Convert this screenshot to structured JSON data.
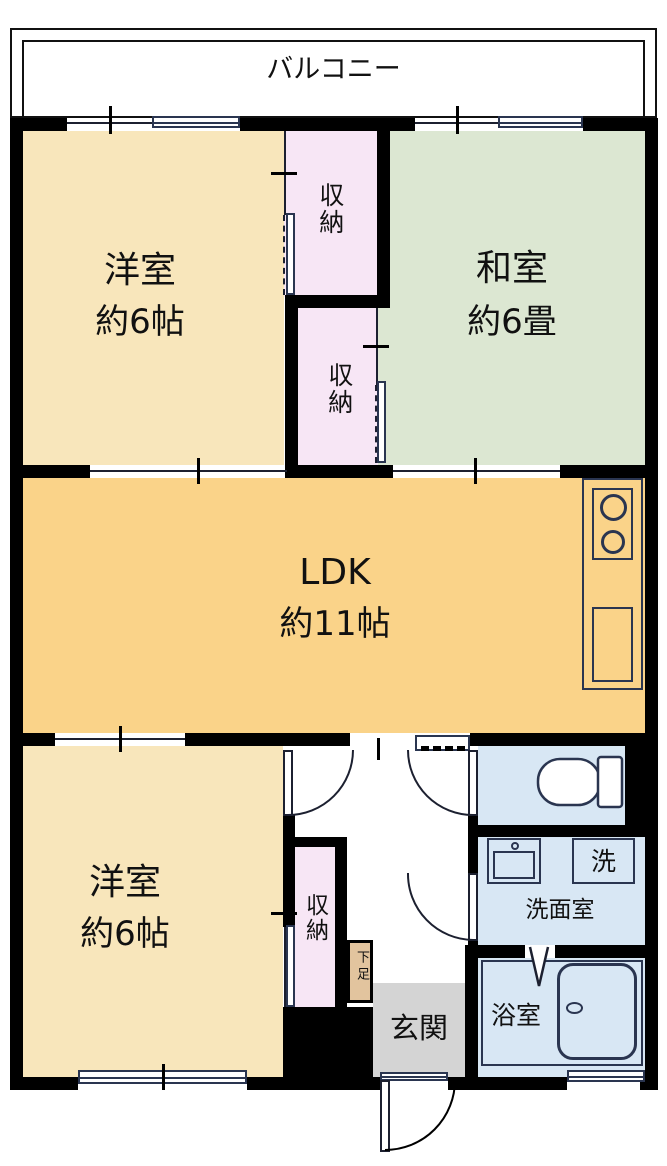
{
  "balcony": {
    "label": "バルコニー"
  },
  "rooms": {
    "yoshitsu_upper": {
      "name": "洋室",
      "size": "約6帖"
    },
    "washitsu": {
      "name": "和室",
      "size": "約6畳"
    },
    "ldk": {
      "name": "LDK",
      "size": "約11帖"
    },
    "yoshitsu_lower": {
      "name": "洋室",
      "size": "約6帖"
    },
    "storage_upper": {
      "label": "収納"
    },
    "storage_lower": {
      "label": "収納"
    },
    "storage_hall": {
      "label": "収納"
    },
    "shoe_cabinet": {
      "label": "下足"
    },
    "genkan": {
      "label": "玄関"
    },
    "bathroom": {
      "label": "浴室"
    },
    "washroom": {
      "label": "洗面室"
    },
    "laundry": {
      "label": "洗"
    }
  },
  "colors": {
    "western_room": "#F8E6BB",
    "ldk": "#FAD389",
    "japanese_room": "#DCE7D2",
    "storage": "#F7E6F5",
    "wet_area": "#D8E7F4",
    "entrance": "#D4D4D4",
    "shoe_cabinet": "#E2C49E",
    "wall": "#000000",
    "fixture_line": "#2A3550"
  }
}
